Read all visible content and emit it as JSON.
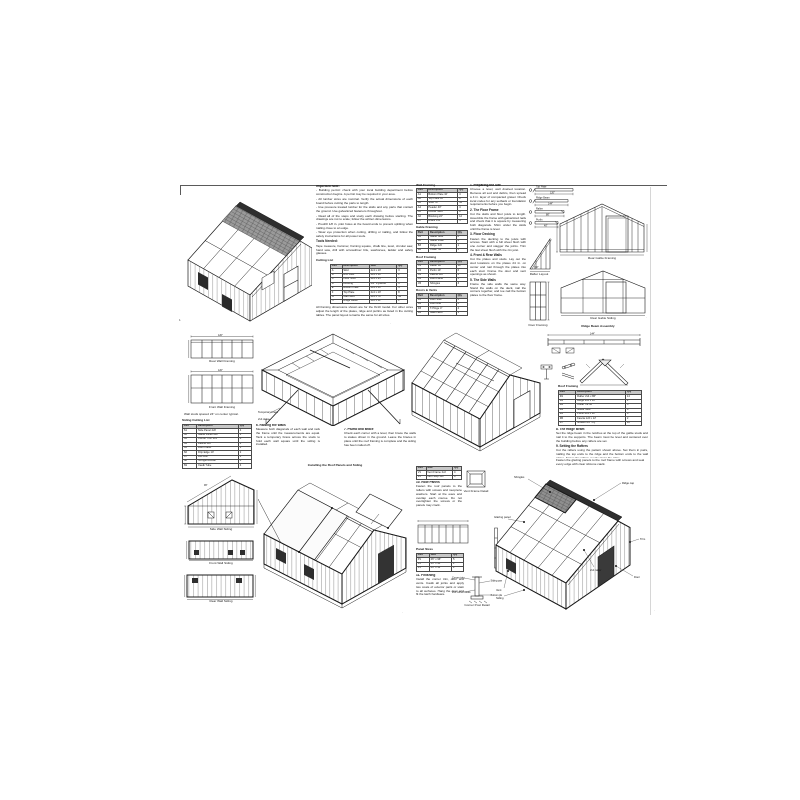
{
  "top": {
    "notes": {
      "title": "Important Note:",
      "bullets": [
        "- Building permit: check with your local building department before construction begins. A permit may be required in your area.",
        "- All lumber sizes are nominal. Verify the actual dimensions of each board before cutting the parts to length.",
        "- Use pressure treated lumber for the skids and any parts that contact the ground. Use galvanized fasteners throughout.",
        "- Read all of the steps and study each drawing before starting. The drawings are not to scale; follow the written dimensions.",
        "- Predrill 1/8 in. pilot holes at the board ends to prevent splitting when nailing close to an edge.",
        "- Wear eye protection when cutting, drilling or nailing, and follow the safety instructions for all power tools."
      ],
      "tools_title": "Tools Needed:",
      "tools_text": "Tape measure, hammer, framing square, chalk line, level, circular saw, hand saw, drill with screwdriver bits, sawhorses, ladder and safety glasses.",
      "cutlist_title": "Cutting List",
      "cutlist": {
        "headers": [
          "Part",
          "Description",
          "Size",
          "Qty"
        ],
        "rows": [
          [
            "A",
            "Skid",
            "4x4 x 10'",
            "3"
          ],
          [
            "B",
            "Rim Joist",
            "2x4 x 10'",
            "2"
          ],
          [
            "C",
            "Floor Joist",
            "2x4 x 93\"",
            "7"
          ],
          [
            "D",
            "Decking",
            "3/4\" Plywood",
            "3"
          ],
          [
            "E",
            "Bottom Plate",
            "2x4 x 10'",
            "4"
          ],
          [
            "F",
            "Top Plate",
            "2x4 x 10'",
            "8"
          ],
          [
            "G",
            "Wall Stud",
            "2x4 x 78\"",
            "34"
          ],
          [
            "H",
            "Ridge Beam",
            "2x6 x 12'",
            "1"
          ]
        ]
      },
      "footnote": "All framing dimensions shown are for the 8x10 model. For other sizes adjust the length of the plates, ridge and purlins as listed in the cutting tables. The panel layout remains the same for all sizes."
    },
    "tables": [
      {
        "title": "Wall Framing",
        "table": {
          "headers": [
            "Part",
            "Description",
            "Qty"
          ],
          "rows": [
            [
              "A1",
              "Bottom Plate 10'",
              "4"
            ],
            [
              "A2",
              "Top Plate 10'",
              "8"
            ],
            [
              "A3",
              "Stud 78\"",
              "34"
            ],
            [
              "A4",
              "Header 40\"",
              "4"
            ],
            [
              "A5",
              "Corner Stud",
              "8"
            ],
            [
              "A6",
              "Blocking 22\"",
              "12"
            ],
            [
              "A7",
              "Brace 1x4",
              "4"
            ]
          ]
        }
      },
      {
        "title": "Gable Framing",
        "table": {
          "headers": [
            "Part",
            "Description",
            "Qty"
          ],
          "rows": [
            [
              "B1",
              "Gable Stud",
              "8"
            ],
            [
              "B2",
              "Gable Plate",
              "4"
            ],
            [
              "B3",
              "Ridge 2x6",
              "1"
            ],
            [
              "B4",
              "Collar Tie",
              "5"
            ]
          ]
        }
      },
      {
        "title": "Roof Framing",
        "table": {
          "headers": [
            "Part",
            "Description",
            "Qty"
          ],
          "rows": [
            [
              "C1",
              "Rafter 86\"",
              "14"
            ],
            [
              "C2",
              "Purlin 10'",
              "6"
            ],
            [
              "C3",
              "Fascia 1x6",
              "2"
            ],
            [
              "C4",
              "Roof Panel",
              "5"
            ],
            [
              "C5",
              "Shingles",
              "3"
            ]
          ]
        }
      },
      {
        "title": "Doors & Vents",
        "table": {
          "headers": [
            "Part",
            "Description",
            "Qty"
          ],
          "rows": [
            [
              "D1",
              "Door Stile",
              "4"
            ],
            [
              "D2",
              "Door Rail",
              "6"
            ],
            [
              "D3",
              "T-Hinge 4\"",
              "4"
            ],
            [
              "D4",
              "Gate Latch",
              "1"
            ]
          ]
        }
      }
    ],
    "sections": [
      {
        "h": "1. Preparing the Site",
        "p": "Choose a level, well drained location. Remove all sod and debris, then spread a 4 in. layer of compacted gravel. Check local codes for any setback or foundation requirements before you begin."
      },
      {
        "h": "2. The Floor Frame",
        "p": "Cut the skids and floor joists to length. Assemble the frame with galvanized nails and check that it is square by measuring both diagonals. Shim under the skids until the frame is level."
      },
      {
        "h": "3. Floor Decking",
        "p": "Fasten the decking to the joists with screws. Start with a full sheet flush with one corner and stagger the joints. Trim the last sheet flush with the rim joist."
      },
      {
        "h": "4. Front & Rear Walls",
        "p": "Cut the plates and studs. Lay out the stud locations on the plates 24 in. on center and nail through the plates into each stud. Frame the door and vent openings as shown."
      },
      {
        "h": "5. The Side Walls",
        "p": "Frame the side walls the same way. Stand the walls on the deck, nail the corners together, and toe nail the bottom plates to the floor frame."
      }
    ],
    "boards": {
      "names": [
        "Top Plate",
        "Ridge Beam",
        "Rafter",
        "Purlin"
      ],
      "dims": [
        "120\"",
        "144\"",
        "86\"",
        "40\""
      ]
    },
    "triangle": {
      "caption": "Rafter Layout",
      "dim": "30°"
    },
    "door_panel": {
      "caption": "Door Framing"
    },
    "gable_framing": {
      "caption": "Rear Gable Framing"
    },
    "gable_siding": {
      "caption": "Rear Gable Siding"
    }
  },
  "mid": {
    "plan1": {
      "caption": "Rear Wall Framing",
      "dim": "120\""
    },
    "plan2": {
      "caption": "Front Wall Framing",
      "dim": "120\""
    },
    "plan_note": "Wall studs spaced 24\" on center typical.",
    "cutlist_title": "Siding Cutting List",
    "cutlist": {
      "headers": [
        "Part",
        "Description",
        "Qty"
      ],
      "rows": [
        [
          "S1",
          "Side Panel 4x8",
          "4"
        ],
        [
          "S2",
          "Gable Panel 4x8",
          "2"
        ],
        [
          "S3",
          "Corner Trim 1x4",
          "8"
        ],
        [
          "S4",
          "Fascia 1x6",
          "2"
        ],
        [
          "S5",
          "Door Panel",
          "1"
        ],
        [
          "S6",
          "Drip Edge 10'",
          "2"
        ],
        [
          "S7",
          "Felt Roll",
          "1"
        ],
        [
          "S8",
          "Shingle Bundle",
          "3"
        ],
        [
          "S9",
          "Caulk Tube",
          "4"
        ]
      ]
    },
    "sec6": {
      "h": "6. Raising the Walls",
      "p": "Measure both diagonals of each wall and rack the frame until the measurements are equal. Tack a temporary brace across the studs to hold each wall square until the siding is installed."
    },
    "sec7": {
      "h": "7. Plumb and Brace",
      "p": "Check each corner with a level, then brace the walls to stakes driven in the ground. Leave the braces in place until the roof framing is complete and the siding has been nailed off."
    },
    "walls_iso": {
      "labels": [
        "Temporary brace",
        "2x4 stake"
      ]
    },
    "ridge": {
      "caption": "Ridge Beam Assembly",
      "dim": "144\""
    },
    "rafter_table_title": "Roof Framing",
    "rafter_table": {
      "headers": [
        "Part",
        "Description",
        "Qty"
      ],
      "rows": [
        [
          "R1",
          "Rafter 2x4 x 86\"",
          "14"
        ],
        [
          "R2",
          "Ridge 2x6 x 12'",
          "1"
        ],
        [
          "R3",
          "Collar Tie 36\"",
          "5"
        ],
        [
          "R4",
          "Gable Stud",
          "8"
        ],
        [
          "R5",
          "Purlin 2x4 x 10'",
          "6"
        ],
        [
          "R6",
          "Fascia 1x6 x 12'",
          "2"
        ],
        [
          "R7",
          "Gusset 1/2\" Ply",
          "10"
        ]
      ]
    },
    "sec8": {
      "h": "8. The Ridge Beam",
      "p": "Set the ridge beam in the notches at the top of the gable studs and nail it to the supports. The beam must be level and centered over the building before any rafters are set."
    },
    "sec9": {
      "h": "9. Setting the Rafters",
      "p": "Cut the rafters using the pattern shown above. Set them in pairs, nailing the top ends to the ridge and the bottom ends to the wall plates. Space the rafters evenly along the ridge."
    }
  },
  "bottom": {
    "elevA": {
      "caption": "Side Wall Siding",
      "dim": "96\""
    },
    "elevB": {
      "caption": "Front Wall Siding"
    },
    "elevC": {
      "caption": "Rear Wall Siding"
    },
    "center_caption": "Installing the Roof Panels and Siding",
    "mini_table": {
      "headers": [
        "Part",
        "Size",
        "Qty"
      ],
      "rows": [
        [
          "V1",
          "Vent Frame 2x2",
          "4"
        ],
        [
          "V2",
          "Vent Stop 1x2",
          "4"
        ]
      ]
    },
    "vent": {
      "caption": "Vent Frame Detail"
    },
    "sec10": {
      "h": "10. Roof Panels",
      "p": "Fasten the roof panels to the rafters with screws and neoprene washers. Start at the eave and overlap each course. Do not overtighten the screws or the panels may crack."
    },
    "panel_table_title": "Panel Sizes",
    "panel_table": {
      "headers": [
        "Part",
        "Size",
        "Qty"
      ],
      "rows": [
        [
          "P1",
          "26\" x 96\"",
          "5"
        ],
        [
          "P2",
          "26\" x 44\"",
          "2"
        ],
        [
          "P3",
          "26\" x 12\"",
          "2"
        ]
      ]
    },
    "sec11": {
      "h": "11. Finishing",
      "p": "Install the corner trim, door and vents. Caulk all joints and apply two coats of exterior paint or stain to all surfaces. Hang the door and fit the latch hardware."
    },
    "post": {
      "caption": "Corner Post Detail",
      "labels": [
        "Corner trim",
        "Siding panel",
        "2x4 corner studs",
        "Bottom plate"
      ]
    },
    "right_caption": "Fasten the glazing panels to the roof frame with screws and seal every edge with clear silicone caulk.",
    "iso5": {
      "labels": [
        "Ridge cap",
        "Shingles",
        "Glazing panel",
        "2x4 rafter",
        "Door",
        "Trim",
        "Vent",
        "Siding"
      ]
    }
  },
  "marks": [
    "1",
    "·",
    "·",
    "·",
    "·"
  ]
}
